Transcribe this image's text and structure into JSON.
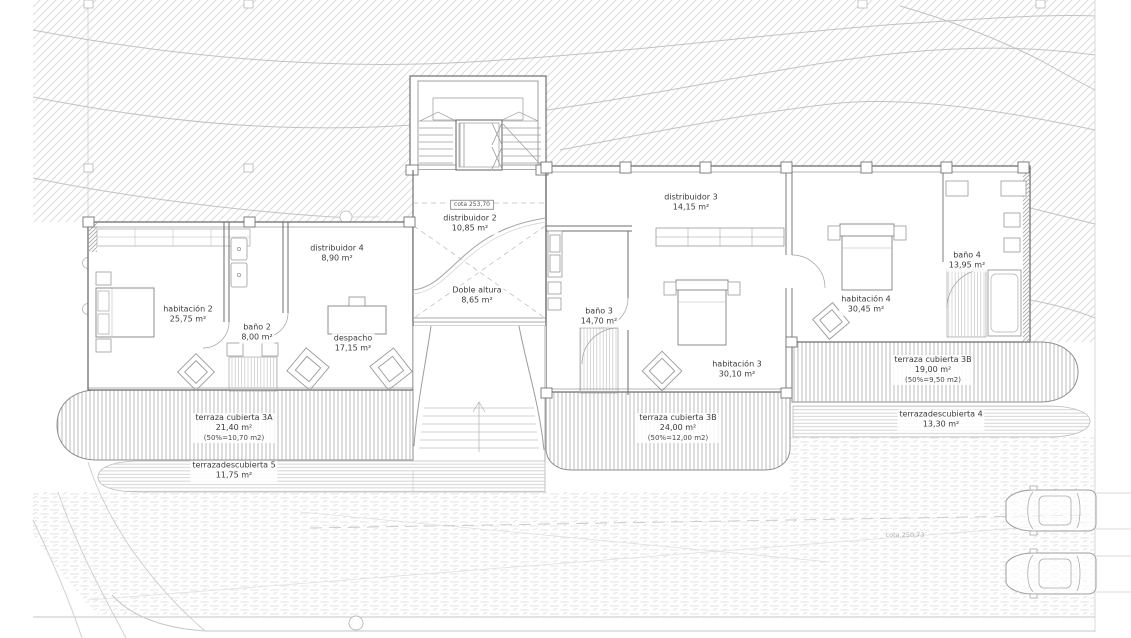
{
  "drawing": {
    "type": "architectural floor plan",
    "language": "es"
  },
  "colors": {
    "background": "#ffffff",
    "wall": "#6e6e6e",
    "fixture": "#9a9a9a",
    "terrain_hatch": "#dcdcdc",
    "contour": "#c2c2c2",
    "deck_hatch": "#b4b4b4",
    "ground_hatch": "#dadada",
    "text": "#3b3b3b",
    "muted_text": "#b3b3b3"
  },
  "rooms": [
    {
      "id": "habitacion-2",
      "lines": [
        "habitación 2",
        "25,75 m²"
      ],
      "x": 188,
      "y": 315
    },
    {
      "id": "bano-2",
      "lines": [
        "baño 2",
        "8,00 m²"
      ],
      "x": 257,
      "y": 333
    },
    {
      "id": "despacho",
      "lines": [
        "despacho",
        "17,15 m²"
      ],
      "x": 353,
      "y": 344
    },
    {
      "id": "distribuidor-4",
      "lines": [
        "distribuidor 4",
        "8,90 m²"
      ],
      "x": 337,
      "y": 254
    },
    {
      "id": "distribuidor-2",
      "lines": [
        "distribuidor 2",
        "10,85 m²"
      ],
      "x": 470,
      "y": 224
    },
    {
      "id": "doble-altura",
      "lines": [
        "Doble altura",
        "8,65 m²"
      ],
      "x": 477,
      "y": 296
    },
    {
      "id": "distribuidor-3",
      "lines": [
        "distribuidor 3",
        "14,15 m²"
      ],
      "x": 691,
      "y": 203
    },
    {
      "id": "bano-3",
      "lines": [
        "baño 3",
        "14,70 m²"
      ],
      "x": 599,
      "y": 317
    },
    {
      "id": "habitacion-3",
      "lines": [
        "habitación 3",
        "30,10 m²"
      ],
      "x": 737,
      "y": 370
    },
    {
      "id": "habitacion-4",
      "lines": [
        "habitación 4",
        "30,45 m²"
      ],
      "x": 866,
      "y": 305
    },
    {
      "id": "bano-4",
      "lines": [
        "baño 4",
        "13,95 m²"
      ],
      "x": 967,
      "y": 261
    },
    {
      "id": "terraza-cubierta-3a",
      "lines": [
        "terraza cubierta 3A",
        "21,40 m²",
        "(50%=10,70 m2)"
      ],
      "x": 234,
      "y": 428
    },
    {
      "id": "terraza-descubierta-5",
      "lines": [
        "terrazadescubierta 5",
        "11,75 m²"
      ],
      "x": 234,
      "y": 471
    },
    {
      "id": "terraza-cubierta-3b-24",
      "lines": [
        "terraza cubierta 3B",
        "24,00 m²",
        "(50%=12,00 m2)"
      ],
      "x": 678,
      "y": 428
    },
    {
      "id": "terraza-cubierta-3b-19",
      "lines": [
        "terraza cubierta 3B",
        "19,00 m²",
        "(50%=9,50 m2)"
      ],
      "x": 933,
      "y": 370
    },
    {
      "id": "terraza-descubierta-4",
      "lines": [
        "terrazadescubierta 4",
        "13,30 m²"
      ],
      "x": 941,
      "y": 420
    }
  ],
  "cotas": [
    {
      "id": "cota-253-70",
      "text": "cota 253,70",
      "x": 472,
      "y": 205,
      "style": "boxed"
    },
    {
      "id": "cota-250-73",
      "text": "cota 250,73",
      "x": 905,
      "y": 535,
      "style": "muted"
    }
  ]
}
